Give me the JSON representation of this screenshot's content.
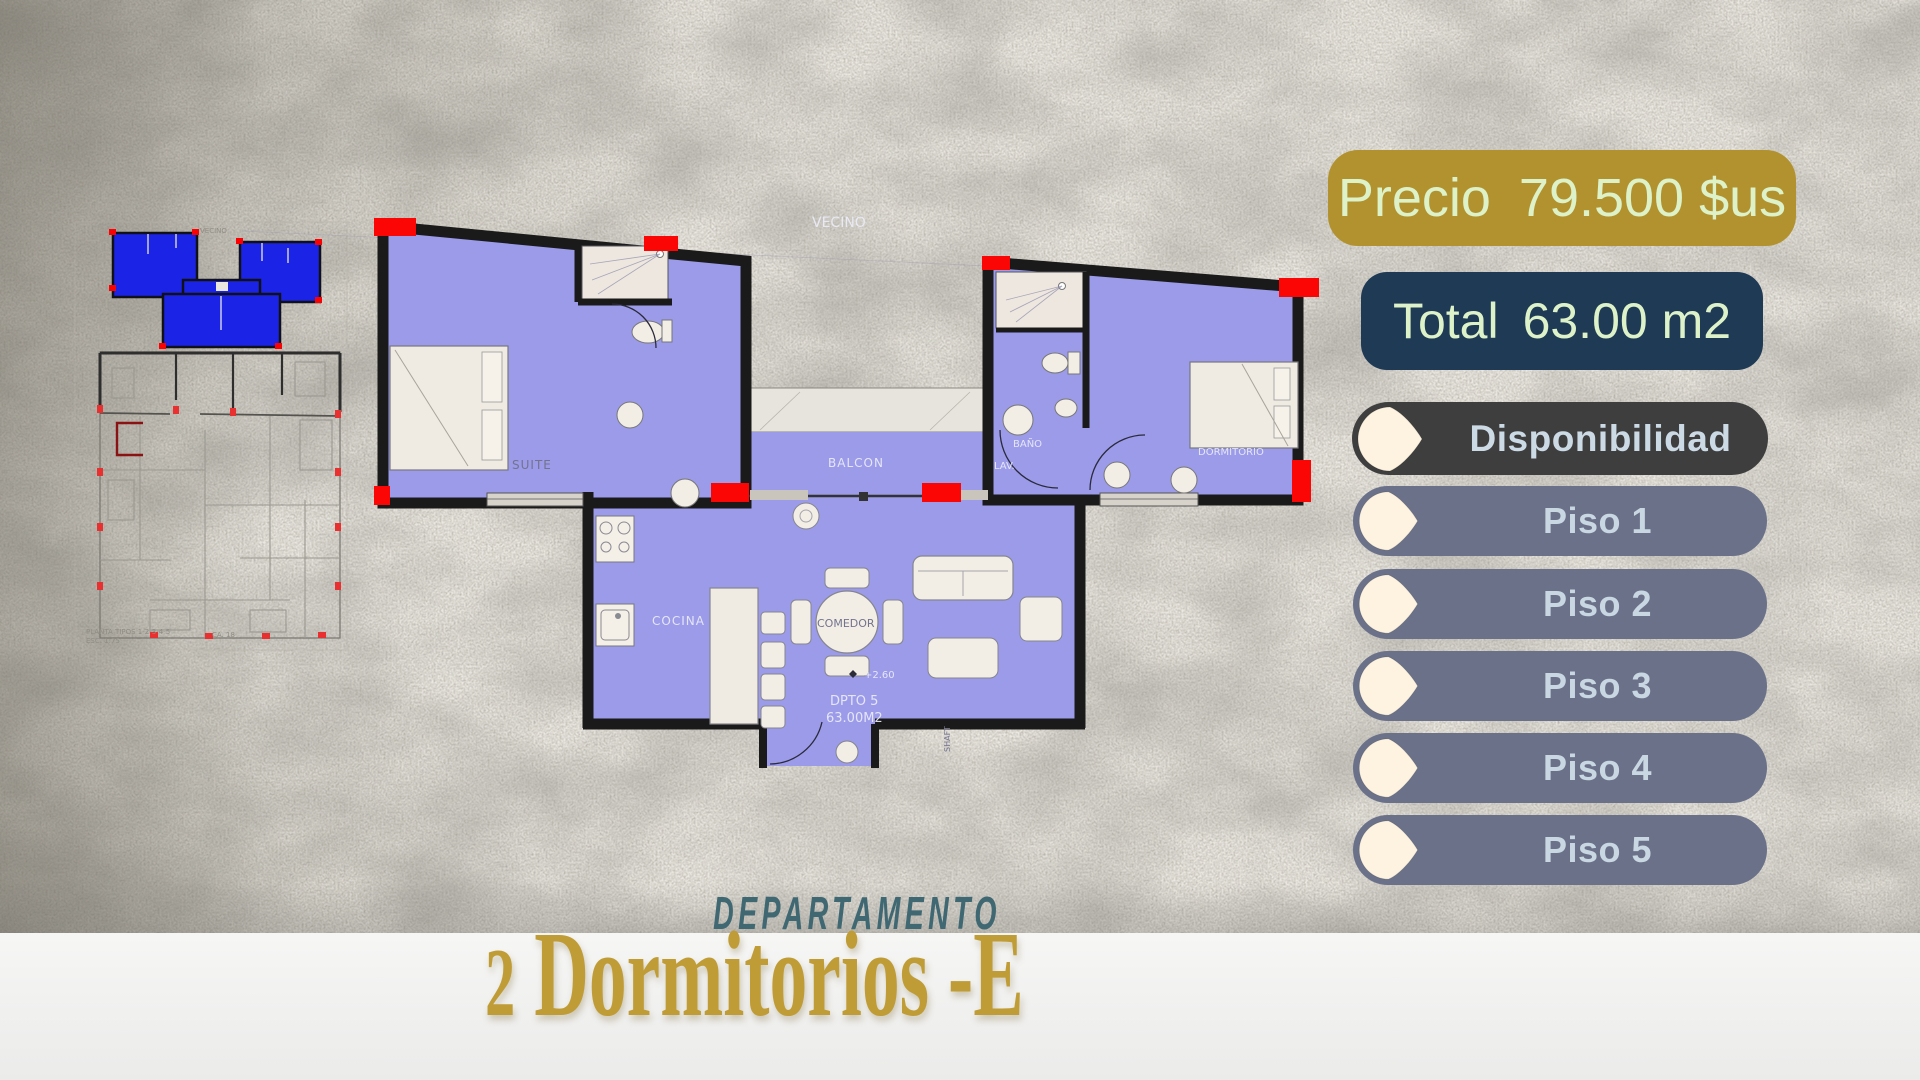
{
  "panel": {
    "price": {
      "label": "Precio",
      "value": "79.500 $us"
    },
    "total": {
      "label": "Total",
      "value": "63.00 m2"
    },
    "availability_header": "Disponibilidad",
    "floors": [
      "Piso 1",
      "Piso 2",
      "Piso 3",
      "Piso 4",
      "Piso 5"
    ]
  },
  "title": {
    "kicker": "DEPARTAMENTO",
    "number": "2",
    "name": " Dormitorios -E"
  },
  "plan_labels": {
    "vecino": "VECINO",
    "suite": "SUITE",
    "balcon": "BALCON",
    "bano": "BAÑO",
    "lav": "LAV.",
    "dormitorio": "DORMITORIO",
    "cocina": "COCINA",
    "comedor": "COMEDOR",
    "level": "+2.60",
    "unit": "DPTO 5",
    "area": "63.00M2",
    "shaft": "SHAFT"
  },
  "thumbnail_labels": {
    "vecino": "VECINO",
    "planta": "PLANTA TIPOS 1-2-3-4-5",
    "escala": "ESC. 1:75",
    "calle": "CA. 18"
  },
  "colors": {
    "gold": "#b2922f",
    "navy": "#1e3a55",
    "dark_pill": "#3e3e3e",
    "slate_pill": "#6a7189",
    "cream": "#fdf3e0",
    "light_green": "#ddf2c8",
    "room_fill": "#9b9be9",
    "highlight_blue": "#1b24e6",
    "marker_red": "#fa0203",
    "title_gold": "#bf9c35",
    "kicker_teal": "#3c6570"
  }
}
